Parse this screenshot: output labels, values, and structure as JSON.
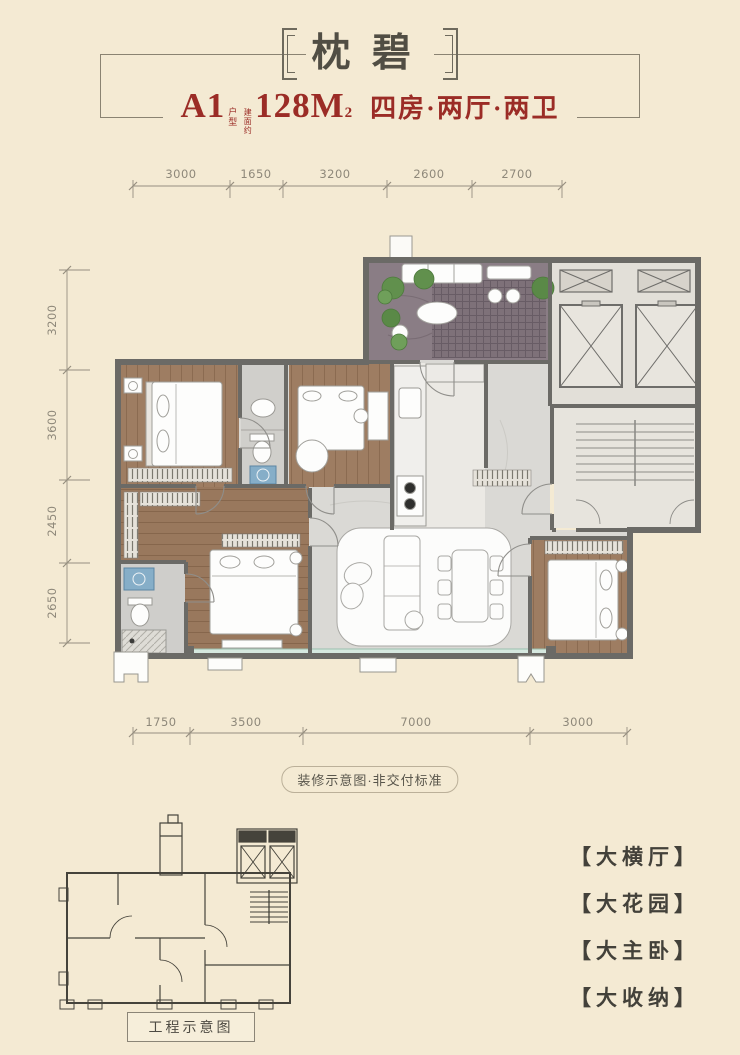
{
  "poster": {
    "title": "枕碧",
    "unit": {
      "name": "A1",
      "name_suffix": "户型",
      "area_prefix": "建面约",
      "area": "128M",
      "area_sup": "2",
      "rooms": "四房·两厅·两卫"
    },
    "dimensions": {
      "top": [
        "3000",
        "1650",
        "3200",
        "2600",
        "2700"
      ],
      "left": [
        "3200",
        "3600",
        "2450",
        "2650"
      ],
      "bottom": [
        "1750",
        "3500",
        "7000",
        "3000"
      ]
    },
    "captions": {
      "decor": "装修示意图·非交付标准",
      "engineering": "工程示意图"
    },
    "features": [
      {
        "label": "【大横厅】"
      },
      {
        "label": "【大花园】"
      },
      {
        "label": "【大主卧】"
      },
      {
        "label": "【大收纳】"
      }
    ],
    "colors": {
      "background": "#f4ead3",
      "accent_red": "#9b2c26",
      "ink": "#4c4a41",
      "wall_gray": "#6b6a66",
      "wood_brown": "#9e7d62",
      "stone_gray": "#8a7d85",
      "marble_gray": "#dad9d5",
      "glass_teal": "#d6e8df",
      "plant_green": "#61904d"
    }
  }
}
